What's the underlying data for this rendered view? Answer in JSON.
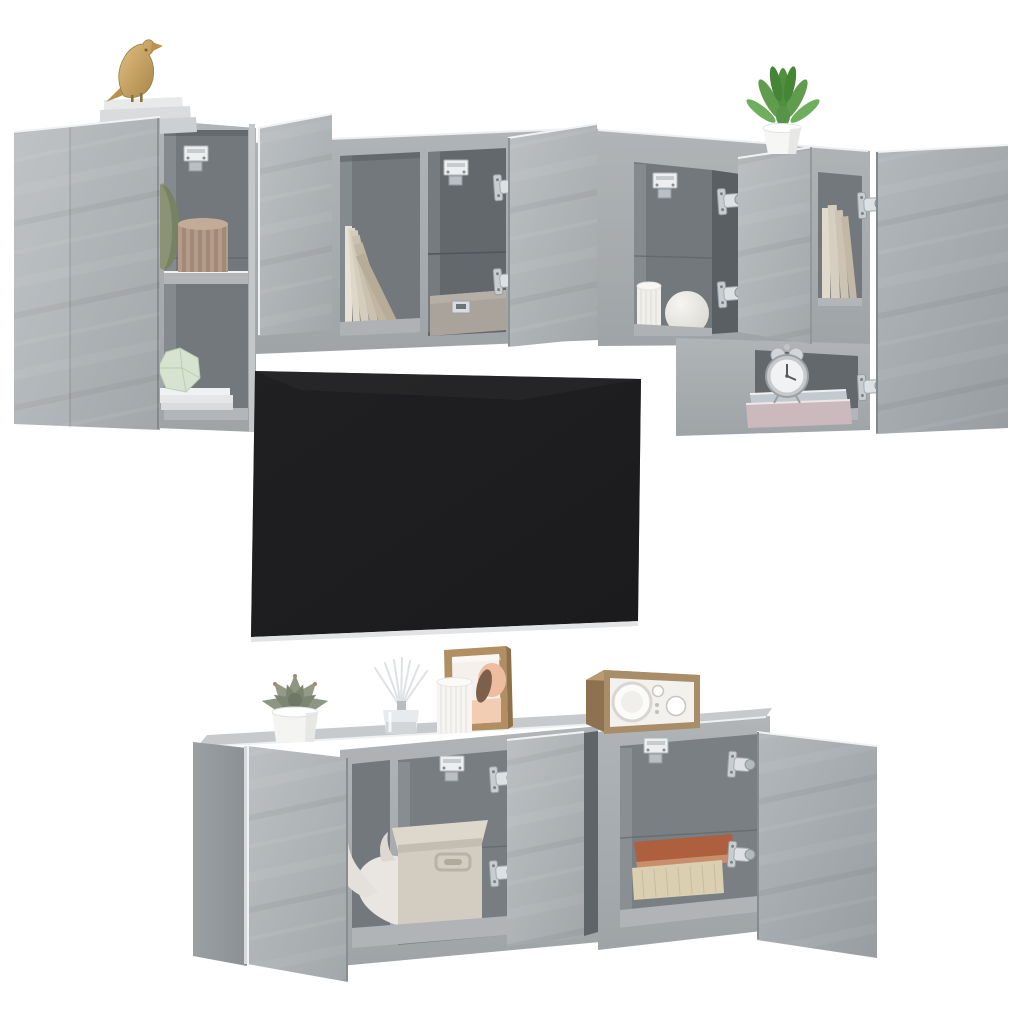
{
  "meta": {
    "title": "Product photo: 6-piece wall-mounted TV media wall set, concrete grey, with open doors and decor",
    "background": "#ffffff",
    "style": "3D render on plain white background, no text"
  },
  "palette": {
    "concrete_light": "#b7bbbe",
    "concrete_mid": "#a6abae",
    "concrete_dark": "#93989c",
    "interior_back": "#73787c",
    "interior_dark": "#63686d",
    "shelf_light": "#b2b6b9",
    "edge_highlight": "#eef0f1",
    "tv_screen": "#1d1d1f",
    "tv_bezel": "#e2e3e4",
    "metal": "#c9cdd0",
    "gold": "#c9a360",
    "plant_green": "#5f9c4e",
    "sage_vase": "#8b9374",
    "tan_vase": "#b39c89",
    "mint": "#d5e3d0",
    "wood": "#a98c68",
    "terracotta_book": "#ad5f3e",
    "cream_book": "#dbcfb2",
    "pink_book": "#ccb9be",
    "blue_book": "#c2cacf",
    "fabric_box": "#d3ccc1",
    "white_decor": "#f4f3f1"
  },
  "scene": {
    "tv": {
      "label": "wall-mounted flat-screen TV, black"
    },
    "units": [
      {
        "label": "tall wall cabinet, top left, door open"
      },
      {
        "label": "wide wall cabinet, top centre, two doors open"
      },
      {
        "label": "wide wall cabinet, top right, door open"
      },
      {
        "label": "tall wall cabinet, far right, door open"
      },
      {
        "label": "wall TV cabinet, bottom left, two doors open"
      },
      {
        "label": "wall TV cabinet, bottom right, door open"
      }
    ],
    "decor": [
      {
        "label": "golden bird figurine"
      },
      {
        "label": "stack of white books on cabinet top"
      },
      {
        "label": "sage green gourd vase"
      },
      {
        "label": "pleated paper vase"
      },
      {
        "label": "mint faceted ornament on white books"
      },
      {
        "label": "leaning cream books"
      },
      {
        "label": "grey gift box with metal label holder"
      },
      {
        "label": "white pleated candle and round vase"
      },
      {
        "label": "standing cream books"
      },
      {
        "label": "artificial green plant in white pot"
      },
      {
        "label": "twin-bell alarm clock on pastel books"
      },
      {
        "label": "succulent in white pot"
      },
      {
        "label": "reed diffuser in glass bottle"
      },
      {
        "label": "ribbed white vase"
      },
      {
        "label": "framed abstract artwork"
      },
      {
        "label": "wooden tabletop radio"
      },
      {
        "label": "white rhino figurine"
      },
      {
        "label": "fabric storage box with handle"
      },
      {
        "label": "terracotta and cream books"
      }
    ],
    "hardware": [
      "soft-close concealed hinges",
      "TV wall-mount brackets"
    ]
  }
}
